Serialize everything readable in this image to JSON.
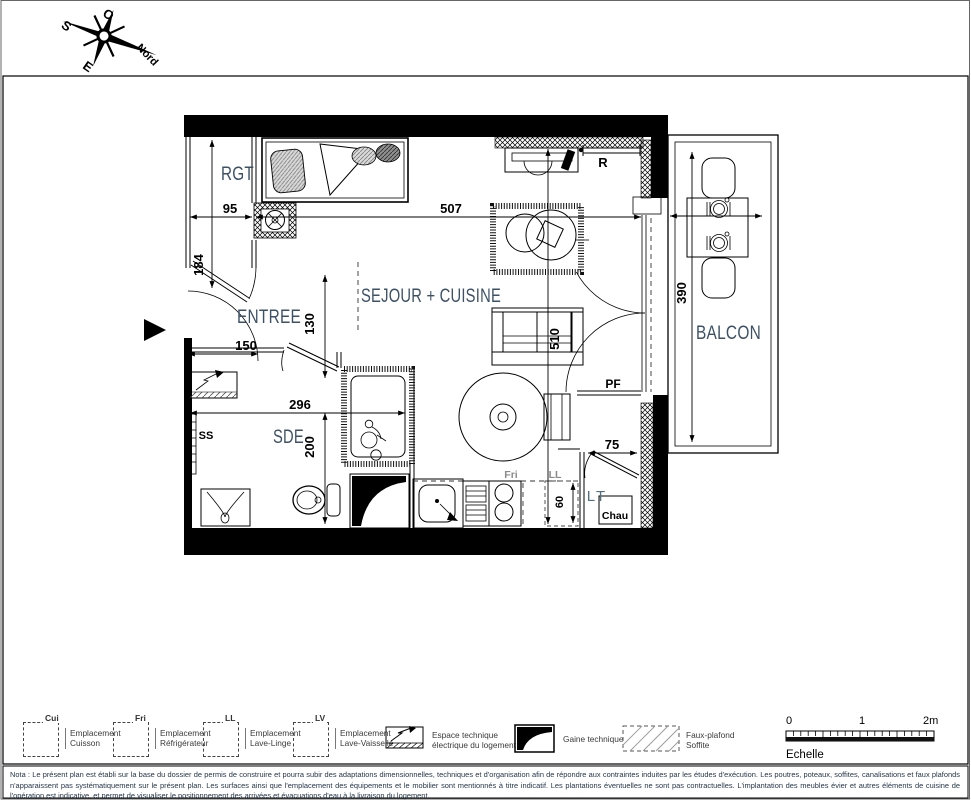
{
  "compass": {
    "o": "O",
    "s": "S",
    "e": "E",
    "nord": "Nord"
  },
  "plan": {
    "rooms": {
      "rgt": "RGT",
      "entree": "ENTREE",
      "sejour": "SEJOUR + CUISINE",
      "sde": "SDE",
      "balcon": "BALCON"
    },
    "dims": {
      "rgt_height": "184",
      "rgt_width": "95",
      "sejour_width": "507",
      "entree_width": "150",
      "entree_height": "130",
      "sde_width": "296",
      "sde_height": "200",
      "sejour_height": "510",
      "appliance_gap": "60",
      "closet_door": "75",
      "balcon_height": "390"
    },
    "tags": {
      "radiator": "R",
      "porte_fenetre": "PF",
      "seche_serviettes": "SS",
      "fridge": "Fri",
      "lave_linge": "LL",
      "local_technique": "LT",
      "chauffe_eau": "Chau"
    }
  },
  "legend": {
    "items": [
      {
        "code": "Cui",
        "line1": "Emplacement",
        "line2": "Cuisson"
      },
      {
        "code": "Fri",
        "line1": "Emplacement",
        "line2": "Réfrigérateur"
      },
      {
        "code": "LL",
        "line1": "Emplacement",
        "line2": "Lave-Linge"
      },
      {
        "code": "LV",
        "line1": "Emplacement",
        "line2": "Lave-Vaisselle"
      },
      {
        "code": "",
        "line1": "Espace technique",
        "line2": "électrique du logement"
      },
      {
        "code": "",
        "line1": "Gaine technique",
        "line2": ""
      },
      {
        "code": "",
        "line1": "Faux-plafond",
        "line2": "Soffite"
      }
    ]
  },
  "scale": {
    "t0": "0",
    "t1": "1",
    "t2": "2m",
    "label": "Echelle"
  },
  "nota": {
    "text": "Nota : Le présent plan est établi sur la base du dossier de permis de construire et pourra subir des adaptations dimensionnelles, techniques et d'organisation afin de répondre aux contraintes induites par les études d'exécution. Les poutres, poteaux, soffites, canalisations et faux plafonds n'apparaissent pas systématiquement sur le présent plan. Les surfaces ainsi que l'emplacement des équipements et le mobilier sont mentionnés à titre indicatif. Les plantations éventuelles ne sont pas contractuelles. L'implantation des meubles évier et autres éléments de cuisine de l'opération est indicative, et permet de visualiser le positionnement des arrivées et évacuations d'eau à la livraison du logement."
  }
}
